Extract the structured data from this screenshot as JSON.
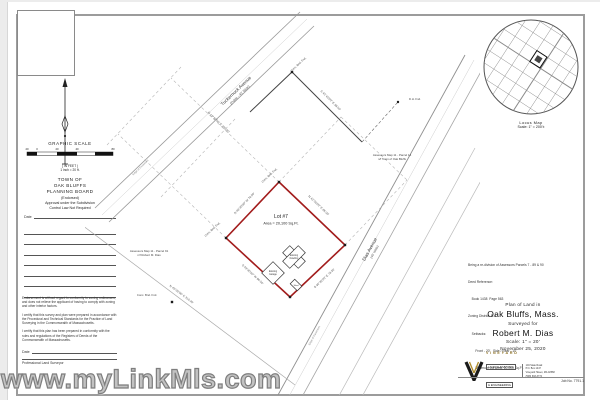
{
  "watermark": {
    "text": "www.myLinkMls.com",
    "color": "#8f8f8f"
  },
  "colors": {
    "lot_boundary_red": "#a21c1c",
    "sheet_border_gray": "#9c9c9c",
    "logo_gold": "#8a6d1f"
  },
  "sidebar": {
    "graphic_scale": {
      "title": "GRAPHIC SCALE",
      "ticks": [
        "20",
        "0",
        "20",
        "40",
        "80"
      ],
      "unit_note": "( IN FEET )",
      "equivalence": "1 inch = 20 ft."
    },
    "planning_board": {
      "line1": "TOWN OF",
      "line2": "OAK BLUFFS",
      "line3": "PLANNING BOARD",
      "line4": "(Endorsed)",
      "line5": "Approval under the Subdivision",
      "line6": "Control Law Not Required",
      "date_label": "Date"
    },
    "certifications": [
      "Endorsement is without regard to conformity to zoning ordinances, and does not relieve the applicant of having to comply with zoning and other interior factors.",
      "I certify that this survey and plan were prepared in accordance with the Procedural and Technical Standards for the Practice of Land Surveying in the Commonwealth of Massachusetts.",
      "I certify that this plan has been prepared in conformity with the rules and regulations of the Registers of Deeds of the Commonwealth of Massachusetts."
    ],
    "date_label": "Date",
    "surveyor_label": "Professional Land Surveyor"
  },
  "locus": {
    "title": "Locus Map",
    "scale": "Scale: 1\" = 200'±"
  },
  "plot": {
    "streets": [
      {
        "name": "Tuckernuck Avenue",
        "note": "(Public - 40' Wide)"
      },
      {
        "name": "Dias Avenue",
        "note": "(40' Wide)"
      }
    ],
    "edge_labels": [
      "Edge of Pavement",
      "Edge of Pavement"
    ],
    "lot": {
      "name": "Lot #7",
      "area": "Area = 20,100 Sq.Ft."
    },
    "buildings": [
      {
        "line1": "Existing",
        "line2": "Dwelling"
      },
      {
        "line1": "Existing",
        "line2": "Garage"
      },
      {
        "line1": "Shed",
        "line2": ""
      }
    ],
    "bearings": [
      "N 46°30'00\" W  78.50'",
      "N 43°30'00\" E  86.00'",
      "S 46°30'00\" E  78.50'",
      "S 43°30'00\" W  86.00'",
      "N 43°30'00\" E  200.00'",
      "N 43°30'00\" E  310.40'",
      "S 45°45'00\" E  99.00'"
    ],
    "markers": [
      "Conc. Bnd. Fnd.",
      "Conc. Bnd. Fnd.",
      "Conc. Bnd. Fnd.",
      "Conc. Bnd. Fnd.",
      "D.H. Fnd."
    ],
    "neighbors": [
      {
        "line1": "Assessors Map 11 - Parcel 91",
        "line2": "n/f Robert M. Dias"
      },
      {
        "line1": "Assessors Map 11 - Parcel 14",
        "line2": "n/f Town of Oak Bluffs"
      }
    ]
  },
  "notes": {
    "lines": [
      "Being a re-division of Assessors Parcels 7 - 89 & 90",
      "Deed Reference:",
      "    Book 1438  Page 563",
      "Zoning District: R-2",
      "    Setbacks:",
      "        Front - 20'   Side / Rear - 10'",
      "        Minimum Lot Area: 10,000 Sq.Ft."
    ]
  },
  "title_block": {
    "line1": "Plan of Land in",
    "place": "Oak Bluffs, Mass.",
    "line3": "Surveyed for",
    "client": "Robert M. Dias",
    "scale": "Scale: 1\" = 20'",
    "date": "November 25, 2020",
    "firm": {
      "name": "VINEYARD",
      "line2": "LAND SURVEYING",
      "line3": "& ENGINEERING",
      "contact": [
        "104 State Road",
        "P.O. Box 1447",
        "Vineyard Haven, MA 02568",
        "(508) 693-3774"
      ]
    },
    "job_no": "Job No. 7791.1"
  }
}
